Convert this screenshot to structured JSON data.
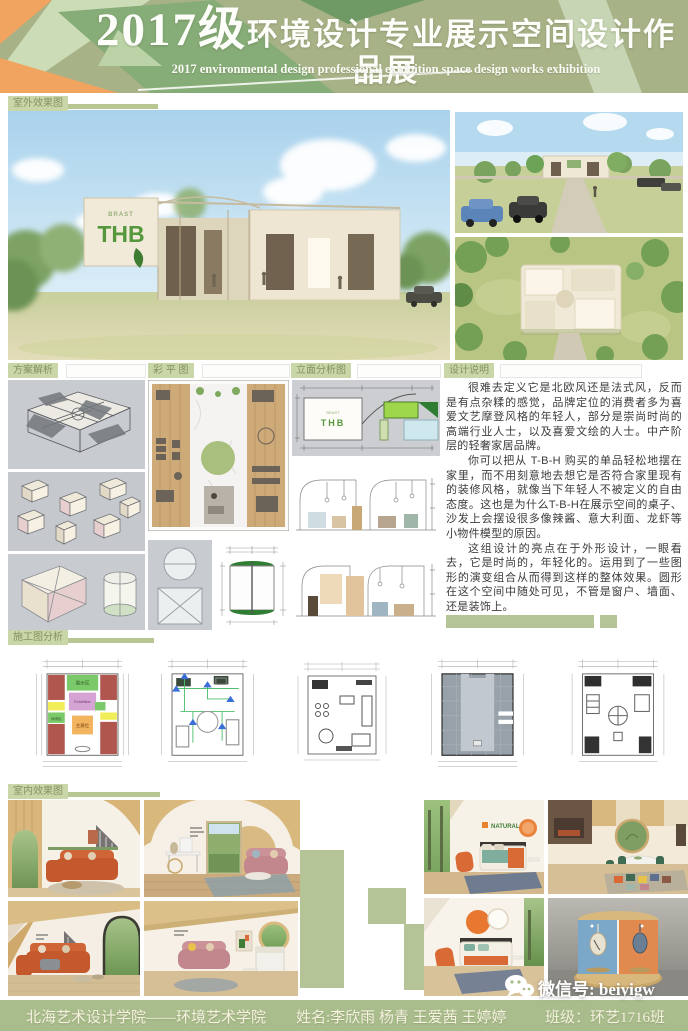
{
  "header": {
    "title_year": "2017级",
    "title_cn": "环境设计专业展示空间设计作品展",
    "title_en": "2017 environmental design professional exhibition space design works exhibition"
  },
  "section_labels": {
    "exterior": "室外效果图",
    "scheme": "方案解析",
    "color_plan": "彩 平 图",
    "elevation": "立面分析图",
    "description": "设计说明",
    "construction": "施工图分析",
    "interior": "室内效果图"
  },
  "building": {
    "sign_top": "BRAST",
    "sign_main": "THB",
    "elevation_sign": "THB"
  },
  "plan_zones": {
    "exhibit": "展示区",
    "exhibition_en": "Exhibition",
    "main_booth": "主展位",
    "leisure": "休闲区"
  },
  "interior": {
    "wall_brand": "NATURAL"
  },
  "description": {
    "p1": "很难去定义它是北欧风还是法式风，反而是有点杂糅的感觉，品牌定位的消费者多为喜爱文艺摩登风格的年轻人，部分是崇尚时尚的高端行业人士，以及喜爱文绘的人士。中产阶层的轻奢家居品牌。",
    "p2": "你可以把从 T-B-H 购买的单品轻松地摆在家里，而不用刻意地去想它是否符合家里现有的装修风格，就像当下年轻人不被定义的自由态度。这也是为什么T-B-H在展示空间的桌子、沙发上会摆设很多像辣酱、意大利面、龙虾等小物件模型的原因。",
    "p3": "这组设计的亮点在于外形设计，一眼看去，它是时尚的，年轻化的。运用到了一些图形的演变组合从而得到这样的整体效果。圆形在这个空间中随处可见，不管是窗户、墙面、还是装饰上。"
  },
  "footer": {
    "school": "北海艺术设计学院——环境艺术学院",
    "names_label": "姓名:",
    "names": "李欣雨  杨青  王爱茜  王婷婷",
    "class_label": "班级：",
    "class_value": "环艺1716班",
    "wechat": "微信号: beiyigw"
  },
  "colors": {
    "banner_sage": "#a8b287",
    "chip_sage": "#c9d6a8",
    "bar_sage": "#b7c693",
    "accent_orange": "#f0a45f",
    "brand_green": "#55973d",
    "footer_bar": "#a9bc8b",
    "sofa_orange": "#c4592e",
    "sofa_pink": "#c2878d"
  }
}
